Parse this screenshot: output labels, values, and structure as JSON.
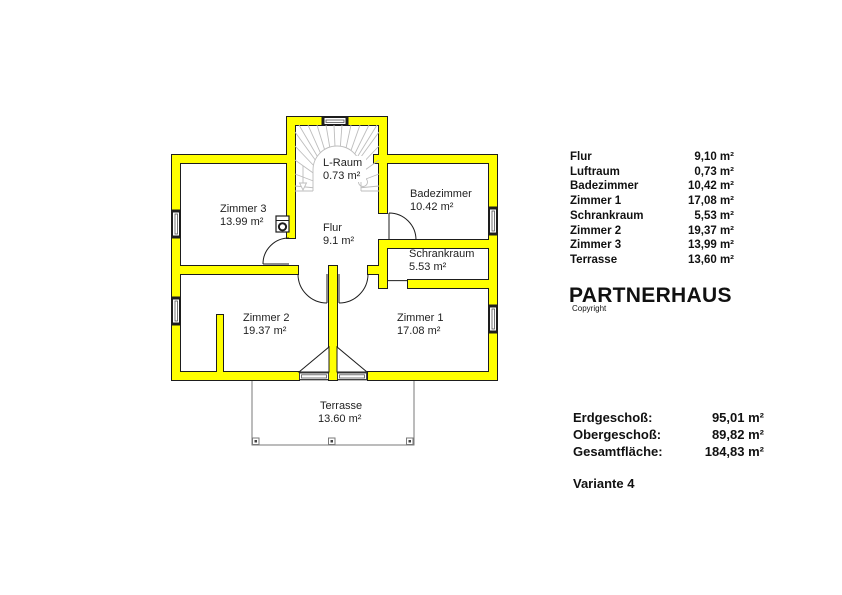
{
  "floor_plan": {
    "rooms": [
      {
        "name": "L-Raum",
        "area": "0.73 m²"
      },
      {
        "name": "Zimmer 3",
        "area": "13.99 m²"
      },
      {
        "name": "Flur",
        "area": "9.1 m²"
      },
      {
        "name": "Badezimmer",
        "area": "10.42 m²"
      },
      {
        "name": "Schrankraum",
        "area": "5.53 m²"
      },
      {
        "name": "Zimmer 2",
        "area": "19.37 m²"
      },
      {
        "name": "Zimmer 1",
        "area": "17.08 m²"
      },
      {
        "name": "Terrasse",
        "area": "13.60 m²"
      }
    ],
    "colors": {
      "wall_fill": "#ffff00",
      "wall_outline": "#1d1d1d",
      "stair_gray": "#bdbdbd",
      "terrace_outline": "#7a7a7a"
    }
  },
  "legend": {
    "rows": [
      {
        "label": "Flur",
        "value": "9,10 m²"
      },
      {
        "label": "Luftraum",
        "value": "0,73 m²"
      },
      {
        "label": "Badezimmer",
        "value": "10,42 m²"
      },
      {
        "label": "Zimmer 1",
        "value": "17,08 m²"
      },
      {
        "label": "Schrankraum",
        "value": "5,53 m²"
      },
      {
        "label": "Zimmer 2",
        "value": "19,37 m²"
      },
      {
        "label": "Zimmer 3",
        "value": "13,99 m²"
      },
      {
        "label": "Terrasse",
        "value": "13,60 m²"
      }
    ]
  },
  "title": "PARTNERHAUS",
  "copyright": "Copyright",
  "summary": {
    "rows": [
      {
        "label": "Erdgeschoß:",
        "value": "95,01 m²"
      },
      {
        "label": "Obergeschoß:",
        "value": "89,82 m²"
      },
      {
        "label": "Gesamtfläche:",
        "value": "184,83 m²"
      }
    ]
  },
  "variant": "Variante 4"
}
